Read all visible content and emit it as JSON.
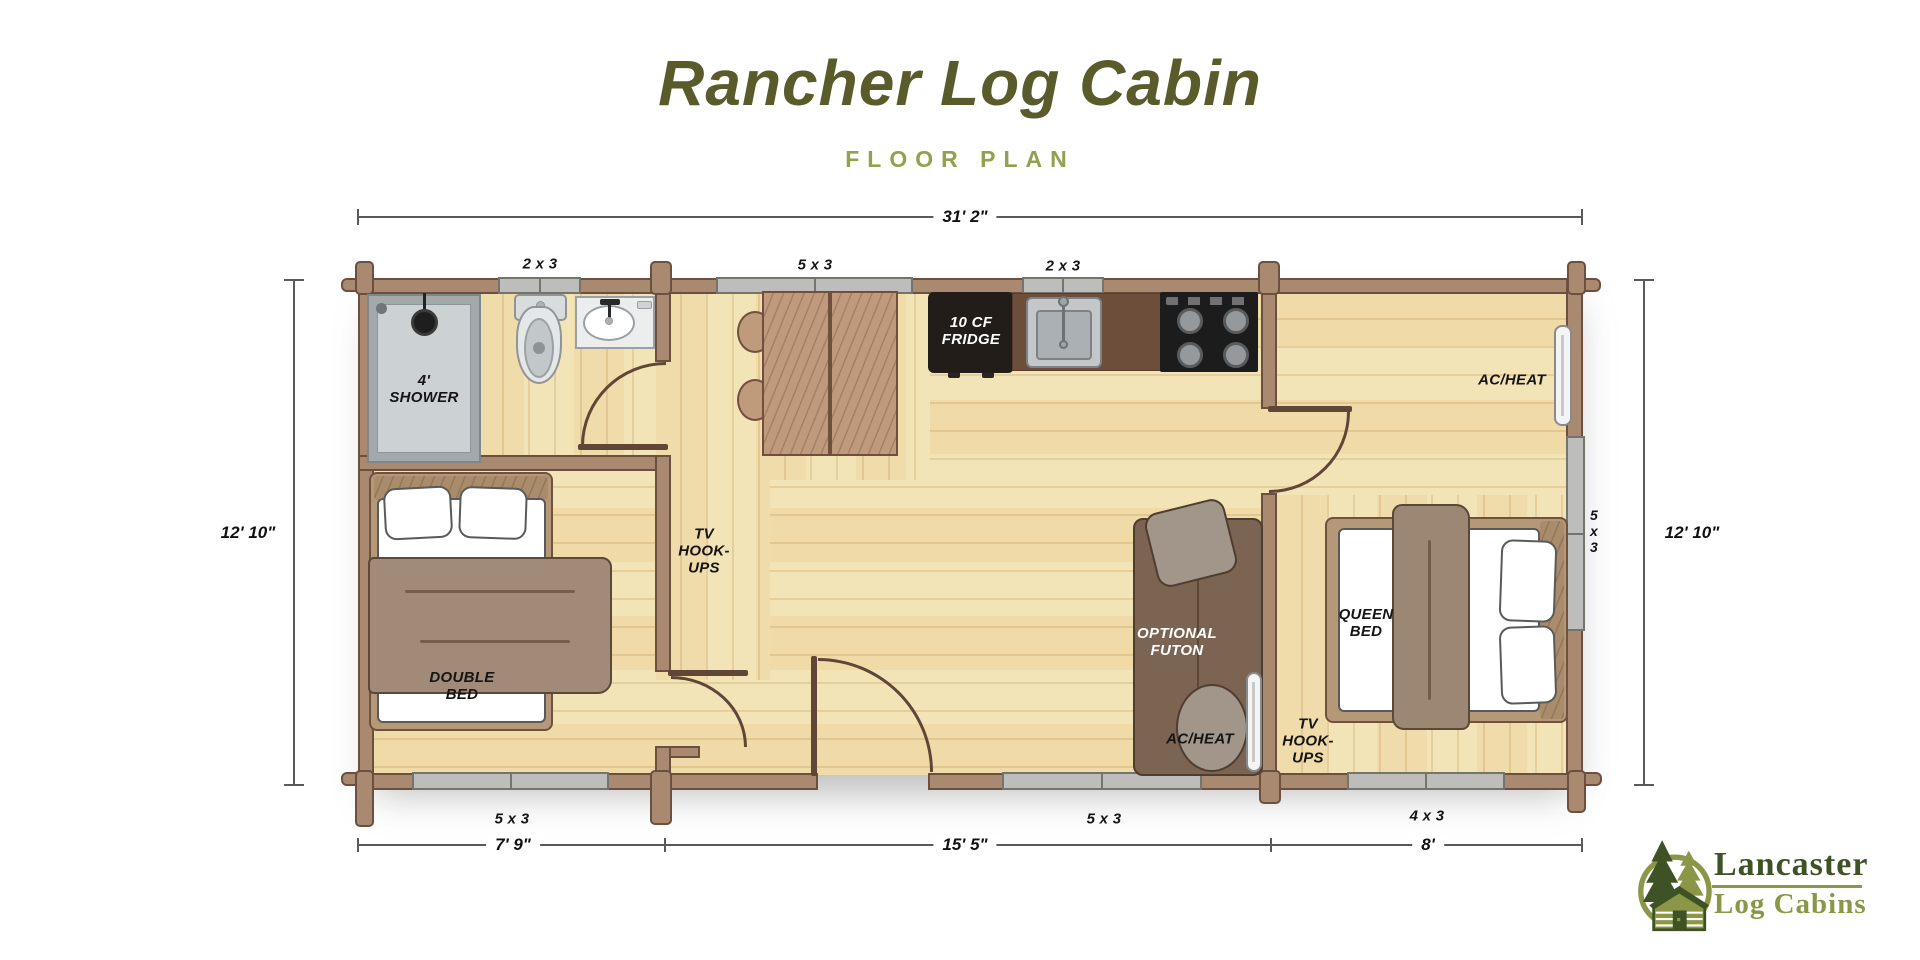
{
  "title": "Rancher Log Cabin",
  "subtitle": "FLOOR PLAN",
  "dimensions": {
    "width": "31' 2\"",
    "left_height": "12' 10\"",
    "right_height": "12' 10\"",
    "bottom": [
      "7' 9\"",
      "15' 5\"",
      "8'"
    ]
  },
  "windows": {
    "top": [
      "2 x 3",
      "5 x 3",
      "2 x 3"
    ],
    "bottom": [
      "5 x 3",
      "5 x 3",
      "4 x 3"
    ],
    "right": [
      "5",
      "x",
      "3"
    ]
  },
  "labels": {
    "shower": [
      "4'",
      "SHOWER"
    ],
    "double_bed": [
      "DOUBLE",
      "BED"
    ],
    "tv_hookups_left": [
      "TV",
      "HOOK-",
      "UPS"
    ],
    "fridge": [
      "10 CF",
      "FRIDGE"
    ],
    "optional_futon": [
      "OPTIONAL",
      "FUTON"
    ],
    "ac_heat_living": "AC/HEAT",
    "tv_hookups_right": [
      "TV",
      "HOOK-",
      "UPS"
    ],
    "queen_bed": [
      "QUEEN",
      "BED"
    ],
    "ac_heat_bedroom": "AC/HEAT"
  },
  "logo": {
    "name": "Lancaster",
    "tagline": "Log Cabins"
  },
  "colors": {
    "title_olive": "#595b2a",
    "accent_olive": "#93a04e",
    "wall_brown": "#a98a70",
    "wall_outline": "#6b4f3f",
    "floor_tan": "#f3e4b8",
    "window_gray": "#bdbdbb",
    "counter_brown": "#6d4e3b",
    "appliance_black": "#1c1c1c",
    "futon_brown": "#7b6451",
    "bed_frame_tan": "#b49878",
    "blanket_taupe": "#a18a77",
    "logo_dark_green": "#3e5226",
    "logo_olive": "#8b9747"
  }
}
